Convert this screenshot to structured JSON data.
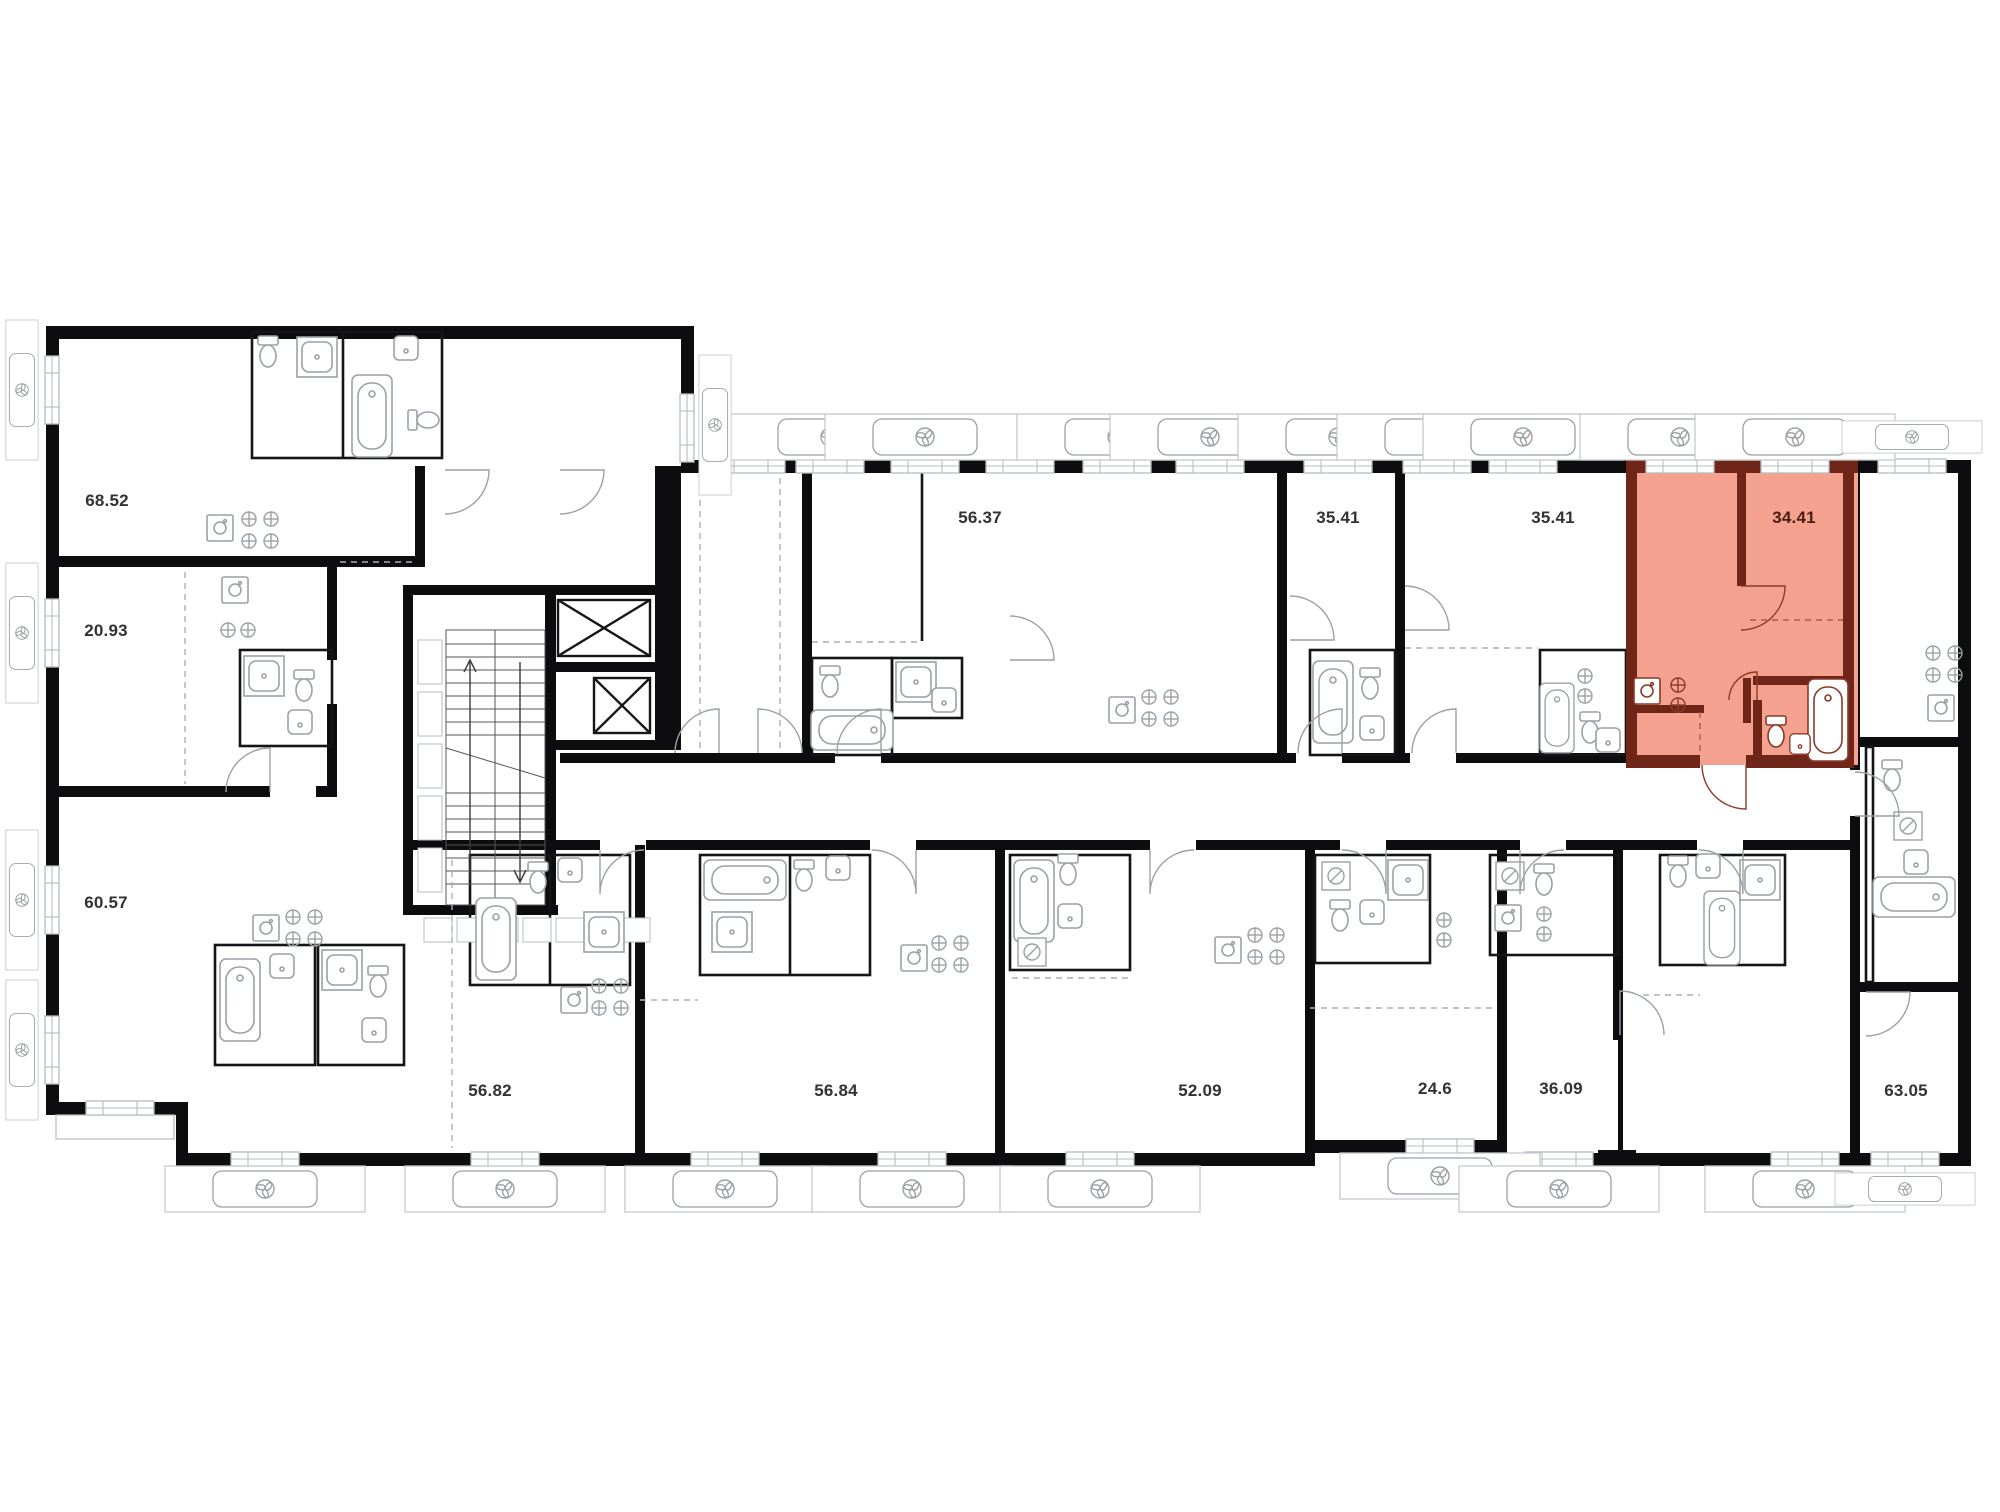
{
  "plan": {
    "type": "residential-floor-plan",
    "units": [
      {
        "area": "68.52",
        "x": 107,
        "y": 501,
        "highlight": false
      },
      {
        "area": "20.93",
        "x": 106,
        "y": 631,
        "highlight": false
      },
      {
        "area": "60.57",
        "x": 106,
        "y": 903,
        "highlight": false
      },
      {
        "area": "56.37",
        "x": 980,
        "y": 518,
        "highlight": false
      },
      {
        "area": "35.41",
        "x": 1338,
        "y": 518,
        "highlight": false
      },
      {
        "area": "35.41",
        "x": 1553,
        "y": 518,
        "highlight": false
      },
      {
        "area": "34.41",
        "x": 1794,
        "y": 518,
        "highlight": true
      },
      {
        "area": "56.82",
        "x": 490,
        "y": 1091,
        "highlight": false
      },
      {
        "area": "56.84",
        "x": 836,
        "y": 1091,
        "highlight": false
      },
      {
        "area": "52.09",
        "x": 1200,
        "y": 1091,
        "highlight": false
      },
      {
        "area": "24.6",
        "x": 1435,
        "y": 1089,
        "highlight": false
      },
      {
        "area": "36.09",
        "x": 1561,
        "y": 1089,
        "highlight": false
      },
      {
        "area": "63.05",
        "x": 1906,
        "y": 1091,
        "highlight": false
      }
    ],
    "highlighted_unit": {
      "area": "34.41",
      "fill": "#F4A28F",
      "wall": "#6F2517",
      "accent": "#8A3A28"
    },
    "colors": {
      "background": "#FFFFFF",
      "wall": "#0D0D0F",
      "thin_wall": "#151517",
      "fixture": "#9BA1A6",
      "window_frame": "#B7BCC1",
      "vent_frame": "#C5CAD0",
      "dashed": "#AAB0B5",
      "label": "#323234",
      "highlight_label": "#4A2015"
    },
    "icons": {
      "fan": "fan-icon",
      "elevator": "elevator-cross-icon",
      "stairs": "stair-treads"
    },
    "vents": [
      {
        "x": 830,
        "y": 437,
        "r": 0,
        "s": 1
      },
      {
        "x": 925,
        "y": 437,
        "r": 0,
        "s": 1
      },
      {
        "x": 1117,
        "y": 437,
        "r": 0,
        "s": 1
      },
      {
        "x": 1210,
        "y": 437,
        "r": 0,
        "s": 1
      },
      {
        "x": 1338,
        "y": 437,
        "r": 0,
        "s": 1
      },
      {
        "x": 1437,
        "y": 437,
        "r": 0,
        "s": 1
      },
      {
        "x": 1523,
        "y": 437,
        "r": 0,
        "s": 1
      },
      {
        "x": 1680,
        "y": 437,
        "r": 0,
        "s": 1
      },
      {
        "x": 1795,
        "y": 437,
        "r": 0,
        "s": 1
      },
      {
        "x": 1912,
        "y": 437,
        "r": 0,
        "s": 0.7
      },
      {
        "x": 715,
        "y": 425,
        "r": 90,
        "s": 0.7
      },
      {
        "x": 22,
        "y": 390,
        "r": 90,
        "s": 0.7
      },
      {
        "x": 22,
        "y": 633,
        "r": 90,
        "s": 0.7
      },
      {
        "x": 22,
        "y": 900,
        "r": 90,
        "s": 0.7
      },
      {
        "x": 22,
        "y": 1050,
        "r": 90,
        "s": 0.7
      },
      {
        "x": 265,
        "y": 1189,
        "r": 0,
        "s": 1
      },
      {
        "x": 505,
        "y": 1189,
        "r": 0,
        "s": 1
      },
      {
        "x": 725,
        "y": 1189,
        "r": 0,
        "s": 1
      },
      {
        "x": 912,
        "y": 1189,
        "r": 0,
        "s": 1
      },
      {
        "x": 1100,
        "y": 1189,
        "r": 0,
        "s": 1
      },
      {
        "x": 1440,
        "y": 1176,
        "r": 0,
        "s": 1
      },
      {
        "x": 1559,
        "y": 1189,
        "r": 0,
        "s": 1
      },
      {
        "x": 1805,
        "y": 1189,
        "r": 0,
        "s": 1
      },
      {
        "x": 1905,
        "y": 1189,
        "r": 0,
        "s": 0.7
      }
    ],
    "windows": [
      {
        "x": 751,
        "y": 466,
        "r": 0
      },
      {
        "x": 830,
        "y": 466,
        "r": 0
      },
      {
        "x": 925,
        "y": 466,
        "r": 0
      },
      {
        "x": 1020,
        "y": 466,
        "r": 0
      },
      {
        "x": 1117,
        "y": 466,
        "r": 0
      },
      {
        "x": 1210,
        "y": 466,
        "r": 0
      },
      {
        "x": 1338,
        "y": 466,
        "r": 0
      },
      {
        "x": 1437,
        "y": 466,
        "r": 0
      },
      {
        "x": 1523,
        "y": 466,
        "r": 0
      },
      {
        "x": 1680,
        "y": 466,
        "r": 0
      },
      {
        "x": 1795,
        "y": 466,
        "r": 0
      },
      {
        "x": 1912,
        "y": 466,
        "r": 0
      },
      {
        "x": 52,
        "y": 390,
        "r": 90
      },
      {
        "x": 52,
        "y": 633,
        "r": 90
      },
      {
        "x": 52,
        "y": 900,
        "r": 90
      },
      {
        "x": 52,
        "y": 1050,
        "r": 90
      },
      {
        "x": 687,
        "y": 428,
        "r": 90
      },
      {
        "x": 120,
        "y": 1108,
        "r": 0
      },
      {
        "x": 265,
        "y": 1159,
        "r": 0
      },
      {
        "x": 505,
        "y": 1159,
        "r": 0
      },
      {
        "x": 725,
        "y": 1159,
        "r": 0
      },
      {
        "x": 912,
        "y": 1159,
        "r": 0
      },
      {
        "x": 1100,
        "y": 1159,
        "r": 0
      },
      {
        "x": 1440,
        "y": 1146,
        "r": 0
      },
      {
        "x": 1559,
        "y": 1159,
        "r": 0
      },
      {
        "x": 1805,
        "y": 1159,
        "r": 0
      },
      {
        "x": 1905,
        "y": 1159,
        "r": 0
      }
    ]
  }
}
